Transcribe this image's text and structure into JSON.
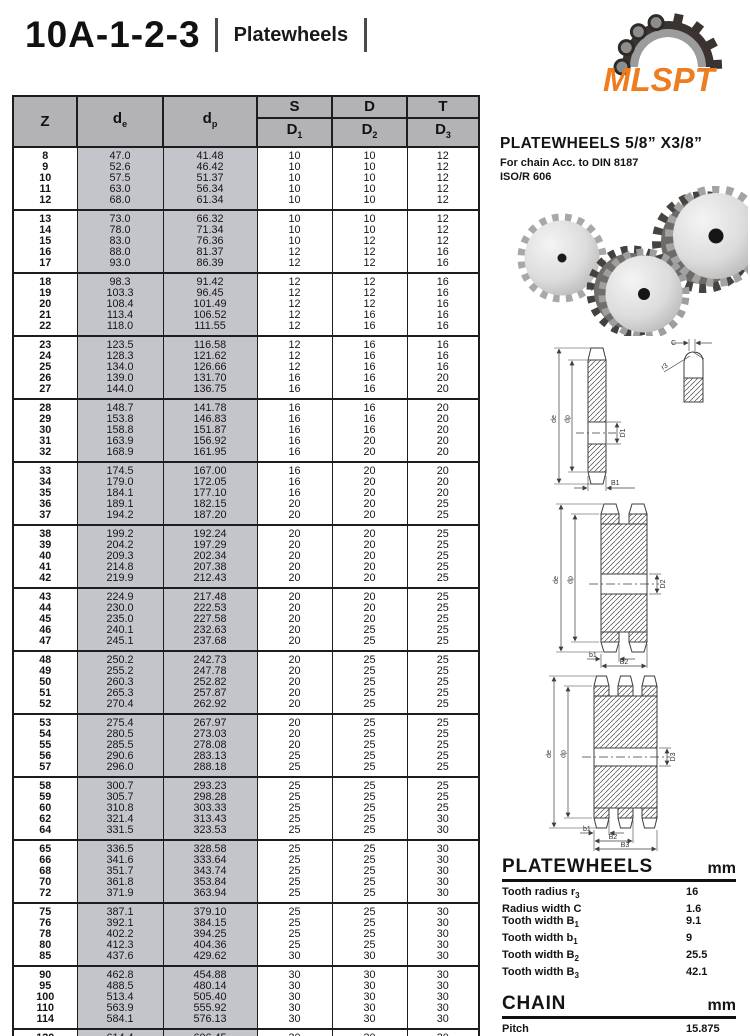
{
  "header": {
    "code": "10A-1-2-3",
    "category": "Platewheels",
    "logo_text": "MLSPT"
  },
  "product": {
    "title": "PLATEWHEELS 5/8” X3/8”",
    "subtitle1": "For chain Acc. to DIN 8187",
    "subtitle2": "ISO/R 606"
  },
  "table": {
    "headers": {
      "z": "Z",
      "de_base": "d",
      "de_sub": "e",
      "dp_base": "d",
      "dp_sub": "p",
      "s": "S",
      "d": "D",
      "t": "T",
      "d_base": "D",
      "d1_sub": "1",
      "d2_sub": "2",
      "d3_sub": "3"
    },
    "groups": [
      [
        [
          "8",
          "47.0",
          "41.48",
          "10",
          "10",
          "12"
        ],
        [
          "9",
          "52.6",
          "46.42",
          "10",
          "10",
          "12"
        ],
        [
          "10",
          "57.5",
          "51.37",
          "10",
          "10",
          "12"
        ],
        [
          "11",
          "63.0",
          "56.34",
          "10",
          "10",
          "12"
        ],
        [
          "12",
          "68.0",
          "61.34",
          "10",
          "10",
          "12"
        ]
      ],
      [
        [
          "13",
          "73.0",
          "66.32",
          "10",
          "10",
          "12"
        ],
        [
          "14",
          "78.0",
          "71.34",
          "10",
          "10",
          "12"
        ],
        [
          "15",
          "83.0",
          "76.36",
          "10",
          "12",
          "12"
        ],
        [
          "16",
          "88.0",
          "81.37",
          "12",
          "12",
          "16"
        ],
        [
          "17",
          "93.0",
          "86.39",
          "12",
          "12",
          "16"
        ]
      ],
      [
        [
          "18",
          "98.3",
          "91.42",
          "12",
          "12",
          "16"
        ],
        [
          "19",
          "103.3",
          "96.45",
          "12",
          "12",
          "16"
        ],
        [
          "20",
          "108.4",
          "101.49",
          "12",
          "12",
          "16"
        ],
        [
          "21",
          "113.4",
          "106.52",
          "12",
          "16",
          "16"
        ],
        [
          "22",
          "118.0",
          "111.55",
          "12",
          "16",
          "16"
        ]
      ],
      [
        [
          "23",
          "123.5",
          "116.58",
          "12",
          "16",
          "16"
        ],
        [
          "24",
          "128.3",
          "121.62",
          "12",
          "16",
          "16"
        ],
        [
          "25",
          "134.0",
          "126.66",
          "12",
          "16",
          "16"
        ],
        [
          "26",
          "139.0",
          "131.70",
          "16",
          "16",
          "20"
        ],
        [
          "27",
          "144.0",
          "136.75",
          "16",
          "16",
          "20"
        ]
      ],
      [
        [
          "28",
          "148.7",
          "141.78",
          "16",
          "16",
          "20"
        ],
        [
          "29",
          "153.8",
          "146.83",
          "16",
          "16",
          "20"
        ],
        [
          "30",
          "158.8",
          "151.87",
          "16",
          "16",
          "20"
        ],
        [
          "31",
          "163.9",
          "156.92",
          "16",
          "20",
          "20"
        ],
        [
          "32",
          "168.9",
          "161.95",
          "16",
          "20",
          "20"
        ]
      ],
      [
        [
          "33",
          "174.5",
          "167.00",
          "16",
          "20",
          "20"
        ],
        [
          "34",
          "179.0",
          "172.05",
          "16",
          "20",
          "20"
        ],
        [
          "35",
          "184.1",
          "177.10",
          "16",
          "20",
          "20"
        ],
        [
          "36",
          "189.1",
          "182.15",
          "20",
          "20",
          "25"
        ],
        [
          "37",
          "194.2",
          "187.20",
          "20",
          "20",
          "25"
        ]
      ],
      [
        [
          "38",
          "199.2",
          "192.24",
          "20",
          "20",
          "25"
        ],
        [
          "39",
          "204.2",
          "197.29",
          "20",
          "20",
          "25"
        ],
        [
          "40",
          "209.3",
          "202.34",
          "20",
          "20",
          "25"
        ],
        [
          "41",
          "214.8",
          "207.38",
          "20",
          "20",
          "25"
        ],
        [
          "42",
          "219.9",
          "212.43",
          "20",
          "20",
          "25"
        ]
      ],
      [
        [
          "43",
          "224.9",
          "217.48",
          "20",
          "20",
          "25"
        ],
        [
          "44",
          "230.0",
          "222.53",
          "20",
          "20",
          "25"
        ],
        [
          "45",
          "235.0",
          "227.58",
          "20",
          "20",
          "25"
        ],
        [
          "46",
          "240.1",
          "232.63",
          "20",
          "25",
          "25"
        ],
        [
          "47",
          "245.1",
          "237.68",
          "20",
          "25",
          "25"
        ]
      ],
      [
        [
          "48",
          "250.2",
          "242.73",
          "20",
          "25",
          "25"
        ],
        [
          "49",
          "255.2",
          "247.78",
          "20",
          "25",
          "25"
        ],
        [
          "50",
          "260.3",
          "252.82",
          "20",
          "25",
          "25"
        ],
        [
          "51",
          "265.3",
          "257.87",
          "20",
          "25",
          "25"
        ],
        [
          "52",
          "270.4",
          "262.92",
          "20",
          "25",
          "25"
        ]
      ],
      [
        [
          "53",
          "275.4",
          "267.97",
          "20",
          "25",
          "25"
        ],
        [
          "54",
          "280.5",
          "273.03",
          "20",
          "25",
          "25"
        ],
        [
          "55",
          "285.5",
          "278.08",
          "20",
          "25",
          "25"
        ],
        [
          "56",
          "290.6",
          "283.13",
          "25",
          "25",
          "25"
        ],
        [
          "57",
          "296.0",
          "288.18",
          "25",
          "25",
          "25"
        ]
      ],
      [
        [
          "58",
          "300.7",
          "293.23",
          "25",
          "25",
          "25"
        ],
        [
          "59",
          "305.7",
          "298.28",
          "25",
          "25",
          "25"
        ],
        [
          "60",
          "310.8",
          "303.33",
          "25",
          "25",
          "25"
        ],
        [
          "62",
          "321.4",
          "313.43",
          "25",
          "25",
          "30"
        ],
        [
          "64",
          "331.5",
          "323.53",
          "25",
          "25",
          "30"
        ]
      ],
      [
        [
          "65",
          "336.5",
          "328.58",
          "25",
          "25",
          "30"
        ],
        [
          "66",
          "341.6",
          "333.64",
          "25",
          "25",
          "30"
        ],
        [
          "68",
          "351.7",
          "343.74",
          "25",
          "25",
          "30"
        ],
        [
          "70",
          "361.8",
          "353.84",
          "25",
          "25",
          "30"
        ],
        [
          "72",
          "371.9",
          "363.94",
          "25",
          "25",
          "30"
        ]
      ],
      [
        [
          "75",
          "387.1",
          "379.10",
          "25",
          "25",
          "30"
        ],
        [
          "76",
          "392.1",
          "384.15",
          "25",
          "25",
          "30"
        ],
        [
          "78",
          "402.2",
          "394.25",
          "25",
          "25",
          "30"
        ],
        [
          "80",
          "412.3",
          "404.36",
          "25",
          "25",
          "30"
        ],
        [
          "85",
          "437.6",
          "429.62",
          "30",
          "30",
          "30"
        ]
      ],
      [
        [
          "90",
          "462.8",
          "454.88",
          "30",
          "30",
          "30"
        ],
        [
          "95",
          "488.5",
          "480.14",
          "30",
          "30",
          "30"
        ],
        [
          "100",
          "513.4",
          "505.40",
          "30",
          "30",
          "30"
        ],
        [
          "110",
          "563.9",
          "555.92",
          "30",
          "30",
          "30"
        ],
        [
          "114",
          "584.1",
          "576.13",
          "30",
          "30",
          "30"
        ]
      ],
      [
        [
          "120",
          "614.4",
          "606.45",
          "30",
          "30",
          "30"
        ],
        [
          "125",
          "639.7",
          "631.51",
          "30",
          "30",
          "30"
        ]
      ]
    ]
  },
  "drawings": {
    "simplex": {
      "c": "C",
      "r3": "r3",
      "de": "de",
      "dp": "dp",
      "d1": "D1",
      "b1": "B1"
    },
    "duplex": {
      "de": "de",
      "dp": "dp",
      "d2": "D2",
      "b1": "b1",
      "b2": "B2"
    },
    "triplex": {
      "de": "de",
      "dp": "dp",
      "d3": "D3",
      "b1": "b1",
      "b2": "B2",
      "b3": "B3"
    }
  },
  "specs": {
    "platewheels": {
      "title": "PLATEWHEELS",
      "unit": "mm",
      "rows": [
        {
          "label": "Tooth radius r",
          "sub": "3",
          "value": "16"
        },
        {
          "label": "Radius width C",
          "sub": "",
          "value": "1.6"
        },
        {
          "label": "Tooth width B",
          "sub": "1",
          "value": "9.1"
        },
        {
          "label": "Tooth width b",
          "sub": "1",
          "value": "9"
        },
        {
          "label": "Tooth width B",
          "sub": "2",
          "value": "25.5"
        },
        {
          "label": "Tooth width B",
          "sub": "3",
          "value": "42.1"
        }
      ]
    },
    "chain": {
      "title": "CHAIN",
      "unit": "mm",
      "rows": [
        {
          "label": "Pitch",
          "sub": "",
          "value": "15.875"
        },
        {
          "label": "Internal width",
          "sub": "",
          "value": "9.65"
        },
        {
          "label": "Roller Φ",
          "sub": "",
          "value": "10.16"
        }
      ]
    }
  },
  "colors": {
    "logo_orange": "#ee7d22",
    "table_header_gray": "#b3b3b6",
    "diameter_col_gray": "#c4c4cb",
    "line_dark": "#1d1d1d"
  }
}
